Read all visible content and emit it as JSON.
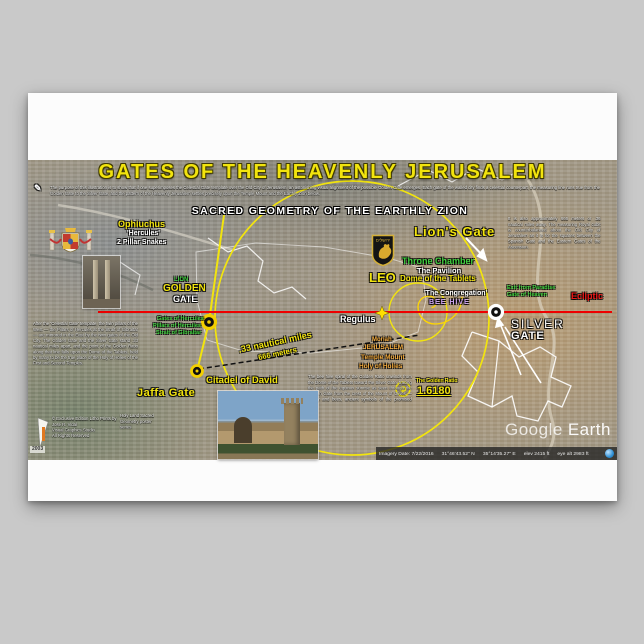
{
  "title": {
    "main": "GATES OF THE HEAVENLY JERUSALEM",
    "subtitle": "SACRED GEOMETRY OF THE EARTHLY ZION"
  },
  "intro": {
    "text": "The purpose of this illustration is to show that if one superimposes the Celestial Gate template over the Old City of Jerusalem, an astonishing visual alignment of the possible Golden Gate emerges. Each gate of the walled city finds a celestial counterpart, the measuring line runs true from the Golden Gate to the Silver Gate, and the pattern of the Heavenly Jerusalem settles precisely upon the Temple Mount and the Earthly Zion below."
  },
  "panels": {
    "left_note": "After the 'Celestial Gate' template, the twin pillars of the West — the Pillars of Hercules at the Strait of Gibraltar — are mirrored in the East by the twin gates of the Old City. The Golden Gate and the Silver Gate stand .33 nautical miles apart, and the point of the Golden Ratio along that line falls upon the Dome of the Tablets, held by many to be the true place of the Holy of Holies of the First and Second Temples.",
    "center_note": "The bee hive spiral of the Golden Ratio unwinds from the Dome of the Tablets toward the Silver Gate, tracing the path of the equinox sunrise as seen through the Golden Gate from the crest of the Mount of Olives — honey and bees, ancient symbols of the promised land.",
    "right_note": "It is also approximately 666 meters or .36 nautical miles away. The measuring Royal cubit is counterbalanced about the Old City of Jerusalem as it is for the squares between the Spanish Gate and the Eastern Gates of the Ascension.",
    "credits": {
      "line1": "© Exclusive Edition Litho Prints by",
      "line2": "José R. Vidal",
      "line3": "Visual Graphics Studio",
      "line4": "All Rights Reserved",
      "stamp": "2003",
      "series_note": "Holy Land Sacred Geometry poster series"
    }
  },
  "labels": {
    "ophiuchus": "Ophiuchus",
    "hercules": "'Hercules'",
    "pillar_snakes": "2 Pillar Snakes",
    "lion_small": "LION",
    "golden": "GOLDEN",
    "gate_word": "GATE",
    "gates_of_hercules": "Gates of Hercules",
    "pillars_of_hercules": "Pillars of Hercules",
    "strait_of_gibraltar": "Strait of Gibraltar",
    "jaffa_gate": "Jaffa Gate",
    "citadel_of_david": "Citadel of David",
    "nautical": ".33 nautical miles",
    "meters": "666 meters",
    "regulus": "Regulus",
    "leo": "LEO",
    "lions_gate": "Lion's Gate",
    "throne_chamber": "Throne Chamber",
    "the_pavilion": "The Pavilion",
    "dome_of_tablets": "Dome of the Tablets",
    "congregation": "'The Congregation'",
    "bee_hive": "BEE HIVE",
    "moriah": "Moriah",
    "jerusalem": "JERUSALEM",
    "temple_mount": "Temple Mount",
    "holy_of_holies": "Holy of Holies",
    "phi": "Φ",
    "golden_ratio_label": "The Golden Ratio",
    "golden_ratio_value": "1.6180",
    "exit_paradise": "Exit from Paradise",
    "gate_of_heaven": "Gate of Heaven",
    "silver": "SILVER",
    "silver_gate_word": "GATE",
    "ecliptic": "Ecliptic",
    "hebrew_jerusalem": "ירושלים"
  },
  "icons": {
    "pen": "✎"
  },
  "watermark": {
    "google": "Google",
    "earth": "Earth"
  },
  "statusbar": {
    "imagery": "Imagery Date: 7/22/2016",
    "lat": "31°46'43.52\" N",
    "lon": "35°14'35.27\" E",
    "elev": "elev 2415 ft",
    "eye": "eye alt 2983 ft"
  },
  "colors": {
    "accent_yellow": "#f2e40e",
    "ecliptic_red": "#ee0000",
    "label_green": "#3ed13e",
    "temple_orange": "#f2a93b",
    "bee_purple": "#cfa6f5"
  }
}
